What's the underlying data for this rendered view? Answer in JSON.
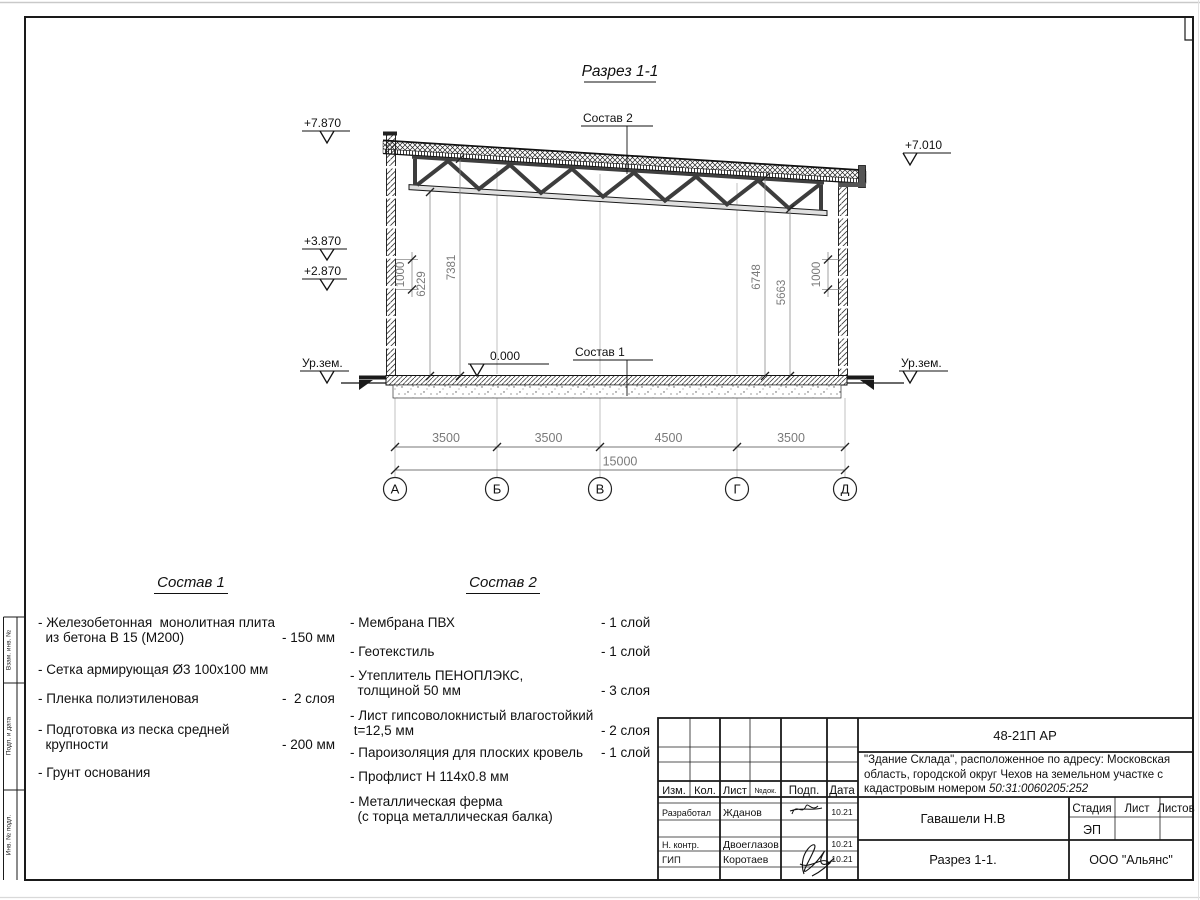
{
  "sheet": {
    "title": "Разрез 1-1"
  },
  "drawing": {
    "elevations": {
      "parapet_left": "+7.870",
      "wall_band_upper": "+3.870",
      "wall_band_lower": "+2.870",
      "roof_right": "+7.010",
      "floor_zero": "0.000"
    },
    "ground_level_left": "Ур.зем.",
    "ground_level_right": "Ур.зем.",
    "callout_roof": "Состав 2",
    "callout_floor": "Состав 1",
    "vertical_dims": {
      "left_band": "1000",
      "left_inner": "6229",
      "left_outer": "7381",
      "right_outer": "6748",
      "right_inner": "5663",
      "right_band": "1000"
    },
    "span_dims": [
      "3500",
      "3500",
      "4500",
      "3500"
    ],
    "total_dim": "15000",
    "axes": [
      "А",
      "Б",
      "В",
      "Г",
      "Д"
    ]
  },
  "composition1": {
    "title": "Состав 1",
    "items": [
      {
        "name": "- Железобетонная  монолитная плита\n  из бетона В 15 (М200)",
        "value": "- 150 мм"
      },
      {
        "name": "- Сетка армирующая Ø3 100х100 мм",
        "value": ""
      },
      {
        "name": "- Пленка полиэтиленовая",
        "value": "-  2 слоя"
      },
      {
        "name": "- Подготовка из песка средней\n  крупности",
        "value": "- 200 мм"
      },
      {
        "name": "- Грунт основания",
        "value": ""
      }
    ]
  },
  "composition2": {
    "title": "Состав 2",
    "items": [
      {
        "name": "- Мембрана ПВХ",
        "value": "- 1 слой"
      },
      {
        "name": "- Геотекстиль",
        "value": "- 1 слой"
      },
      {
        "name": "- Утеплитель ПЕНОПЛЭКС,\n  толщиной 50 мм",
        "value": "- 3 слоя"
      },
      {
        "name": "- Лист гипсоволокнистый влагостойкий\n t=12,5 мм",
        "value": "- 2 слоя"
      },
      {
        "name": "- Пароизоляция для плоских кровель",
        "value": "- 1 слой"
      },
      {
        "name": "- Профлист Н 114х0.8 мм",
        "value": ""
      },
      {
        "name": "- Металлическая ферма\n  (с торца металлическая балка)",
        "value": ""
      }
    ]
  },
  "titleblock": {
    "doc_code": "48-21П АР",
    "project_description": "\"Здание Склада\", расположенное по адресу: Московская область, городской округ Чехов на земельном участке с кадастровым номером ",
    "cadastral_number": "50:31:0060205:252",
    "headers": {
      "izm": "Изм.",
      "kol": "Кол.",
      "list": "Лист",
      "ndok": "№док.",
      "podp": "Подп.",
      "data": "Дата"
    },
    "rows": [
      {
        "role": "Разработал",
        "name": "Жданов",
        "date": "10.21"
      },
      {
        "role": "Н. контр.",
        "name": "Двоеглазов",
        "date": "10.21"
      },
      {
        "role": "ГИП",
        "name": "Коротаев",
        "date": "10.21"
      }
    ],
    "approver": "Гавашели Н.В",
    "stage_label": "Стадия",
    "sheet_label": "Лист",
    "sheets_label": "Листов",
    "stage_value": "ЭП",
    "drawing_name": "Разрез 1-1.",
    "company": "ООО \"Альянс\""
  },
  "side_stamp": {
    "labels": [
      "Взам. инв. №",
      "Подп. и дата",
      "Инв. № подл."
    ]
  }
}
